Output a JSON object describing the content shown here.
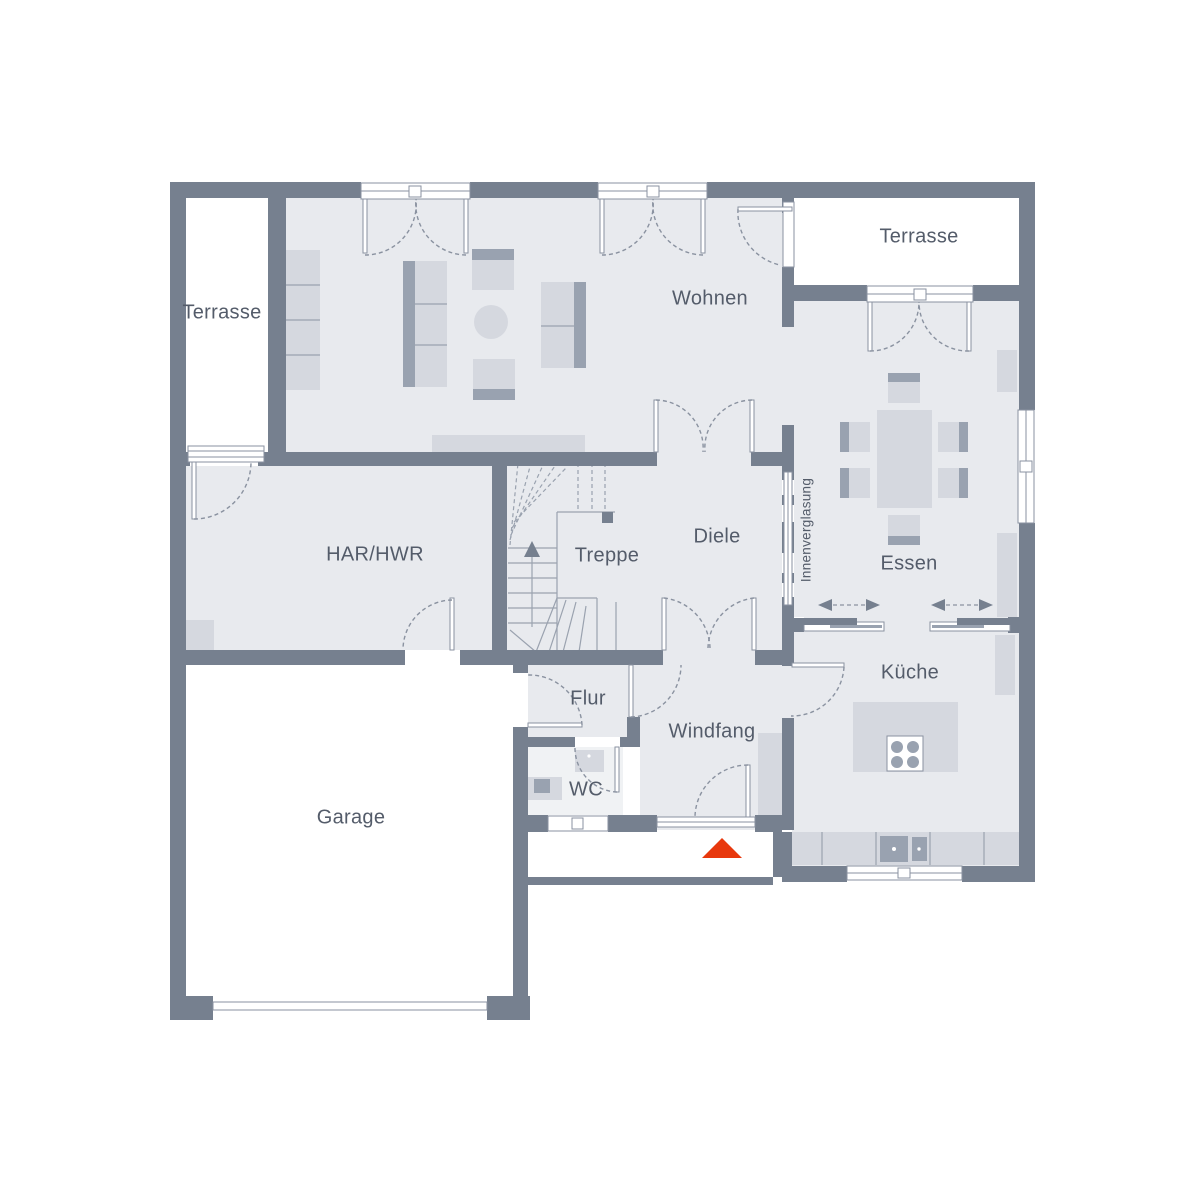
{
  "plan": {
    "type": "floor-plan",
    "rooms": {
      "terrasse_left": "Terrasse",
      "terrasse_right": "Terrasse",
      "wohnen": "Wohnen",
      "har_hwr": "HAR/HWR",
      "treppe": "Treppe",
      "diele": "Diele",
      "essen": "Essen",
      "innenverglasung": "Innenverglasung",
      "flur": "Flur",
      "windfang": "Windfang",
      "wc": "WC",
      "kueche": "Küche",
      "garage": "Garage"
    },
    "icons": {
      "entrance_arrow": "triangle-up-entrance-marker",
      "stairs_direction_arrow": "arrow-up"
    }
  },
  "colors": {
    "wall": "#76808F",
    "floor": "#E8EAEE",
    "floor_wc": "#F0F2F4",
    "white": "#FFFFFF",
    "furniture": "#D5D8DF",
    "furniture_dark": "#99A2B0",
    "outline": "#8A92A0",
    "entrance_arrow": "#E8380D",
    "label": "#545C6A"
  }
}
